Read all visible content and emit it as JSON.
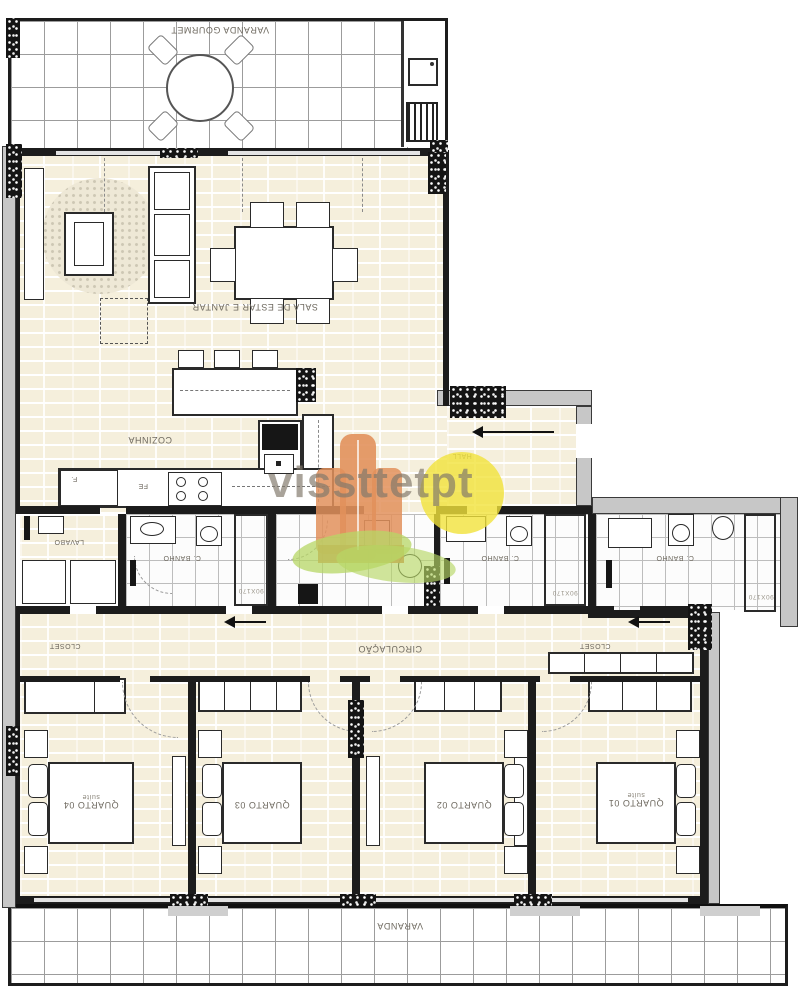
{
  "watermark": {
    "text": "vissttetpt",
    "tower_color": "#e2915c",
    "sun_color": "#f1e23b",
    "leaf_color": "#b7d765",
    "text_color": "#80786a"
  },
  "labels": {
    "varanda_gourmet": "VARANDA GOURMET",
    "sala": "SALA DE ESTAR E JANTAR",
    "cozinha": "COZINHA",
    "hall": "HALL",
    "fe": "FE",
    "f": "F.",
    "lavabo": "LAVABO",
    "banho1": "C. BANHO",
    "banho2": "C. BANHO",
    "banho3": "C. BANHO",
    "banho1_dim": "90X170",
    "banho2_dim": "90X170",
    "banho3_dim": "90X170",
    "closet_left": "CLOSET",
    "closet_right": "CLOSET",
    "circulacao": "CIRCULAÇÃO",
    "quarto1": "QUARTO 01",
    "quarto1_sub": "suíte",
    "quarto2": "QUARTO 02",
    "quarto3": "QUARTO 03",
    "quarto4": "QUARTO 04",
    "quarto4_sub": "suíte",
    "varanda": "VARANDA"
  }
}
